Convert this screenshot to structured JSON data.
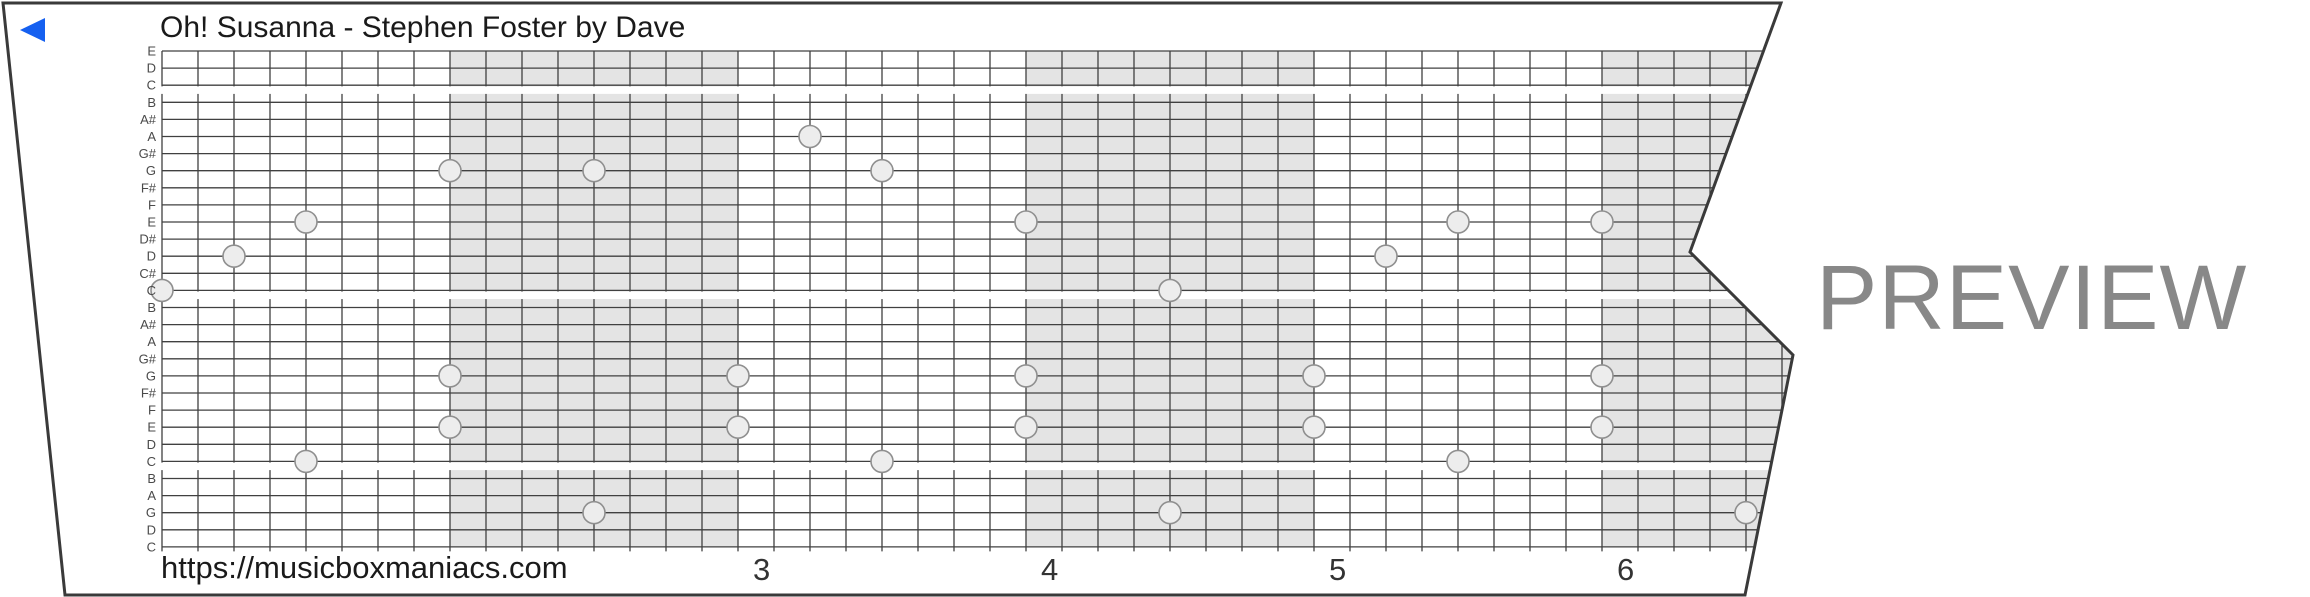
{
  "strip": {
    "title": "Oh! Susanna - Stephen Foster by Dave",
    "footer_url": "https://musicboxmaniacs.com",
    "watermark": "PREVIEW",
    "direction_arrow": "left",
    "note_labels": [
      "E",
      "D",
      "C",
      "B",
      "A#",
      "A",
      "G#",
      "G",
      "F#",
      "F",
      "E",
      "D#",
      "D",
      "C#",
      "C",
      "B",
      "A#",
      "A",
      "G#",
      "G",
      "F#",
      "F",
      "E",
      "D",
      "C",
      "B",
      "A",
      "G",
      "D",
      "C"
    ],
    "octave_break_after_lines": [
      2,
      14,
      24
    ],
    "measures_total": 6,
    "shaded_measure_indices": [
      1,
      3,
      5
    ],
    "measure_numbers": [
      {
        "label": "3",
        "measure_index": 2
      },
      {
        "label": "4",
        "measure_index": 3
      },
      {
        "label": "5",
        "measure_index": 4
      },
      {
        "label": "6",
        "measure_index": 5
      }
    ],
    "notes": [
      {
        "col": 0,
        "line": 14,
        "pitch": "C"
      },
      {
        "col": 2,
        "line": 12,
        "pitch": "D"
      },
      {
        "col": 4,
        "line": 10,
        "pitch": "E"
      },
      {
        "col": 8,
        "line": 7,
        "pitch": "G"
      },
      {
        "col": 12,
        "line": 7,
        "pitch": "G"
      },
      {
        "col": 18,
        "line": 5,
        "pitch": "A"
      },
      {
        "col": 20,
        "line": 7,
        "pitch": "G"
      },
      {
        "col": 24,
        "line": 10,
        "pitch": "E"
      },
      {
        "col": 28,
        "line": 14,
        "pitch": "C"
      },
      {
        "col": 34,
        "line": 12,
        "pitch": "D"
      },
      {
        "col": 36,
        "line": 10,
        "pitch": "E"
      },
      {
        "col": 40,
        "line": 10,
        "pitch": "E"
      },
      {
        "col": 4,
        "line": 24,
        "pitch": "C"
      },
      {
        "col": 8,
        "line": 19,
        "pitch": "G"
      },
      {
        "col": 8,
        "line": 22,
        "pitch": "E"
      },
      {
        "col": 12,
        "line": 27,
        "pitch": "G"
      },
      {
        "col": 16,
        "line": 19,
        "pitch": "G"
      },
      {
        "col": 16,
        "line": 22,
        "pitch": "E"
      },
      {
        "col": 20,
        "line": 24,
        "pitch": "C"
      },
      {
        "col": 24,
        "line": 19,
        "pitch": "G"
      },
      {
        "col": 24,
        "line": 22,
        "pitch": "E"
      },
      {
        "col": 28,
        "line": 27,
        "pitch": "G"
      },
      {
        "col": 32,
        "line": 19,
        "pitch": "G"
      },
      {
        "col": 32,
        "line": 22,
        "pitch": "E"
      },
      {
        "col": 36,
        "line": 24,
        "pitch": "C"
      },
      {
        "col": 40,
        "line": 19,
        "pitch": "G"
      },
      {
        "col": 40,
        "line": 22,
        "pitch": "E"
      },
      {
        "col": 44,
        "line": 27,
        "pitch": "G"
      }
    ]
  },
  "colors": {
    "accent_blue": "#1560F0",
    "measure_shade": "#e4e4e4",
    "grid_line": "#404040",
    "strip_border": "#3a3a3a",
    "note_fill": "#ededed",
    "note_stroke": "#8f8f8f",
    "label_gray": "#4a4a4a",
    "watermark_gray": "#888888"
  }
}
